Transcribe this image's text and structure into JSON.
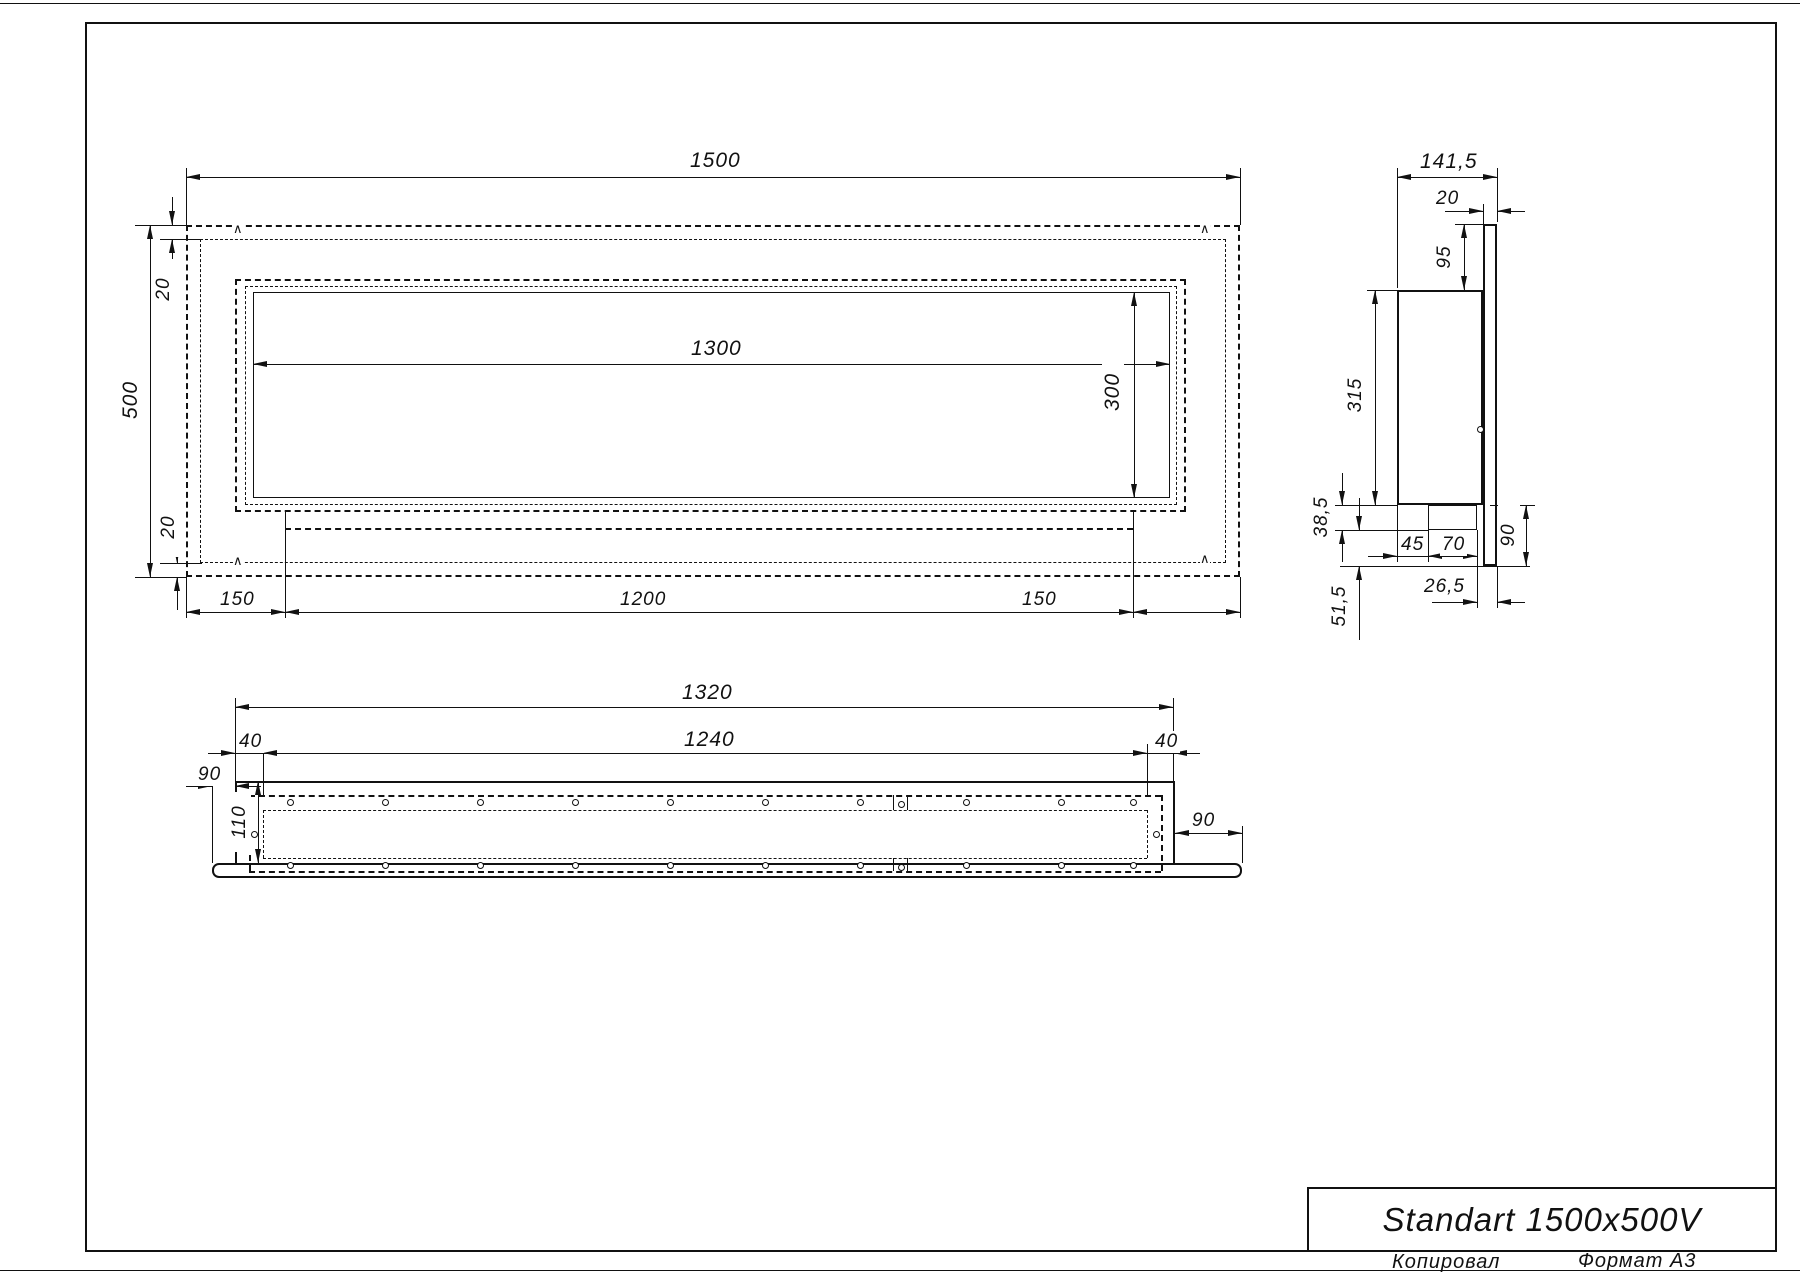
{
  "symbols": {
    "weld": "∧"
  },
  "front_view": {
    "dim_width": "1500",
    "dim_height": "500",
    "dim_top_offset": "20",
    "dim_bottom_offset": "20",
    "dim_opening_width": "1300",
    "dim_opening_height": "300",
    "dim_left_margin": "150",
    "dim_bracket_width": "1200",
    "dim_right_margin": "150"
  },
  "side_view": {
    "dim_depth": "141,5",
    "dim_flange_thickness": "20",
    "dim_top_inset": "95",
    "dim_body_height": "315",
    "dim_bottom_inset": "38,5",
    "dim_tray_offset": "45",
    "dim_tray_width": "70",
    "dim_flange_drop": "90",
    "dim_flange_gap": "26,5",
    "dim_lower_inset": "51,5"
  },
  "bottom_view": {
    "dim_outer_width": "1320",
    "dim_inner_width": "1240",
    "dim_wall_left": "40",
    "dim_wall_right": "40",
    "dim_flange_left": "90",
    "dim_flange_right": "90",
    "dim_depth": "110"
  },
  "title_block": {
    "title": "Standart 1500x500V"
  },
  "footer": {
    "copied_by": "Копировал",
    "format": "Формат А3"
  }
}
